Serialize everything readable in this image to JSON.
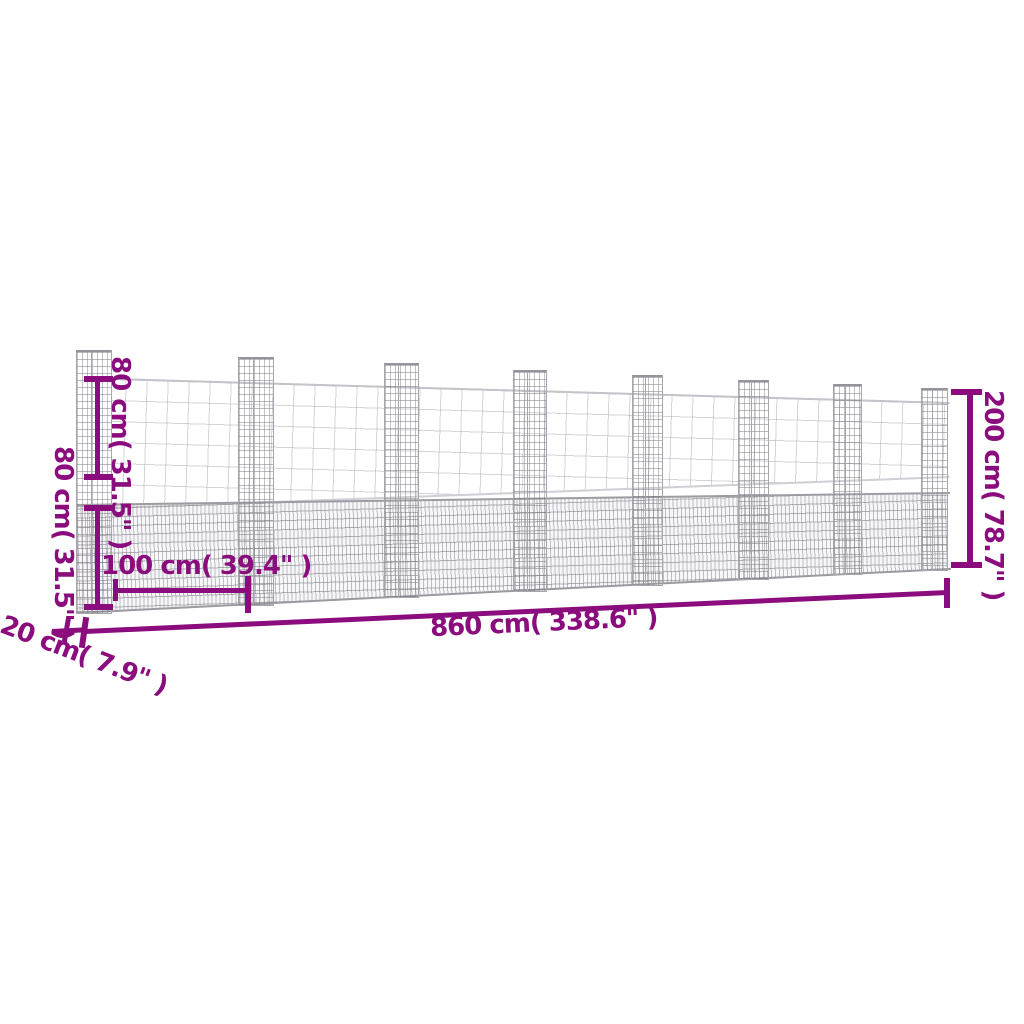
{
  "figure": {
    "type": "product-dimension-diagram",
    "subject": "u-shaped gabion basket fence with 8 posts",
    "background_color": "#ffffff",
    "accent_color": "#8A0C7D",
    "mesh_color": "#b7b7bd"
  },
  "dims": {
    "upper_post_height": "80 cm( 31.5\" )",
    "wall_height": "80 cm( 31.5\" )",
    "post_spacing": "100 cm( 39.4\" )",
    "total_length": "860 cm( 338.6\" )",
    "depth": "20 cm( 7.9\" )",
    "total_height": "200 cm( 78.7\" )"
  }
}
